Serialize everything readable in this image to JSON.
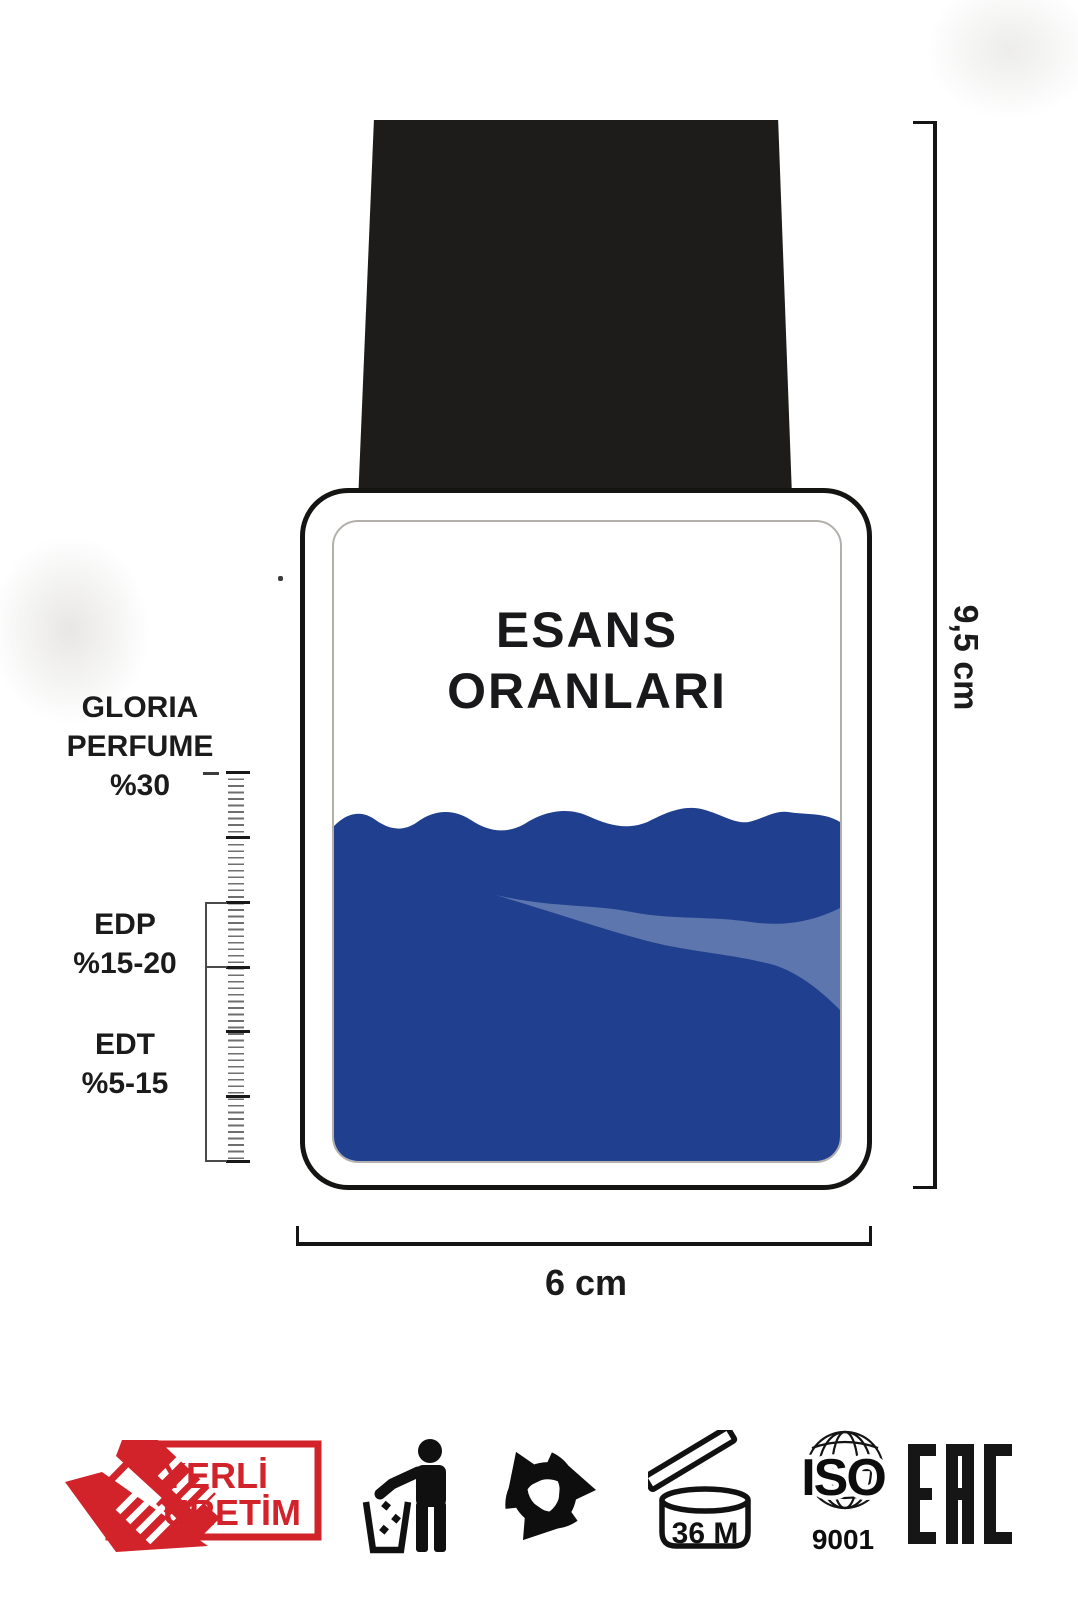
{
  "title": {
    "line1": "ESANS",
    "line2": "ORANLARI"
  },
  "scale": {
    "gloria": {
      "line1": "GLORIA",
      "line2": "PERFUME",
      "value": "%30"
    },
    "edp": {
      "label": "EDP",
      "value": "%15-20"
    },
    "edt": {
      "label": "EDT",
      "value": "%5-15"
    }
  },
  "dimensions": {
    "height": "9,5 cm",
    "width": "6 cm"
  },
  "badges": {
    "yerli": {
      "line1": "YERLİ",
      "line2": "ÜRETİM"
    },
    "pao": {
      "label": "36 M"
    },
    "iso": {
      "label": "ISO",
      "number": "9001"
    },
    "eac": {
      "label": "EAC"
    }
  },
  "colors": {
    "liquid": "#20408f",
    "liquid_highlight": "#5d76ae",
    "cap": "#1d1c1a",
    "accent_red": "#d2232a"
  }
}
